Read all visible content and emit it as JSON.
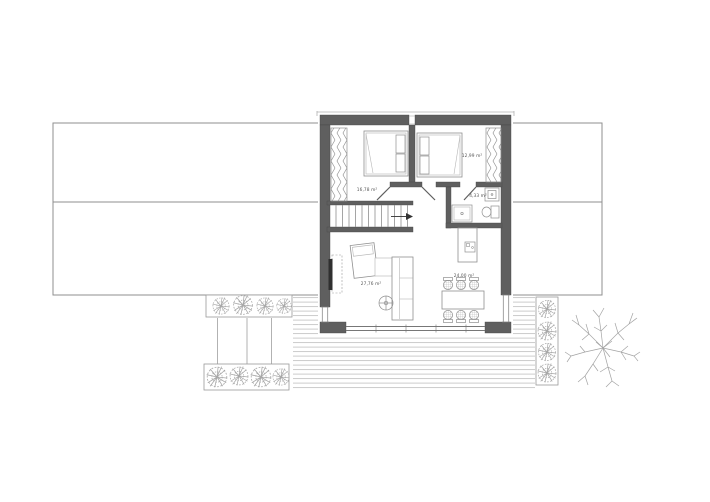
{
  "plan": {
    "rooms": {
      "bedroom_left": {
        "area_label": "16,78 m²"
      },
      "bedroom_right": {
        "area_label": "12,99 m²"
      },
      "bathroom": {
        "area_label": "4,33 m²"
      },
      "living_room": {
        "area_label": "27,76 m²"
      },
      "kitchen_dining": {
        "area_label": "24,00 m²"
      }
    },
    "colors": {
      "wall": "#5f5f5f",
      "line": "#8f8f8f",
      "thin_line": "#b5b5b5",
      "deck_line": "#c6c6c6",
      "label_text": "#555555"
    }
  }
}
